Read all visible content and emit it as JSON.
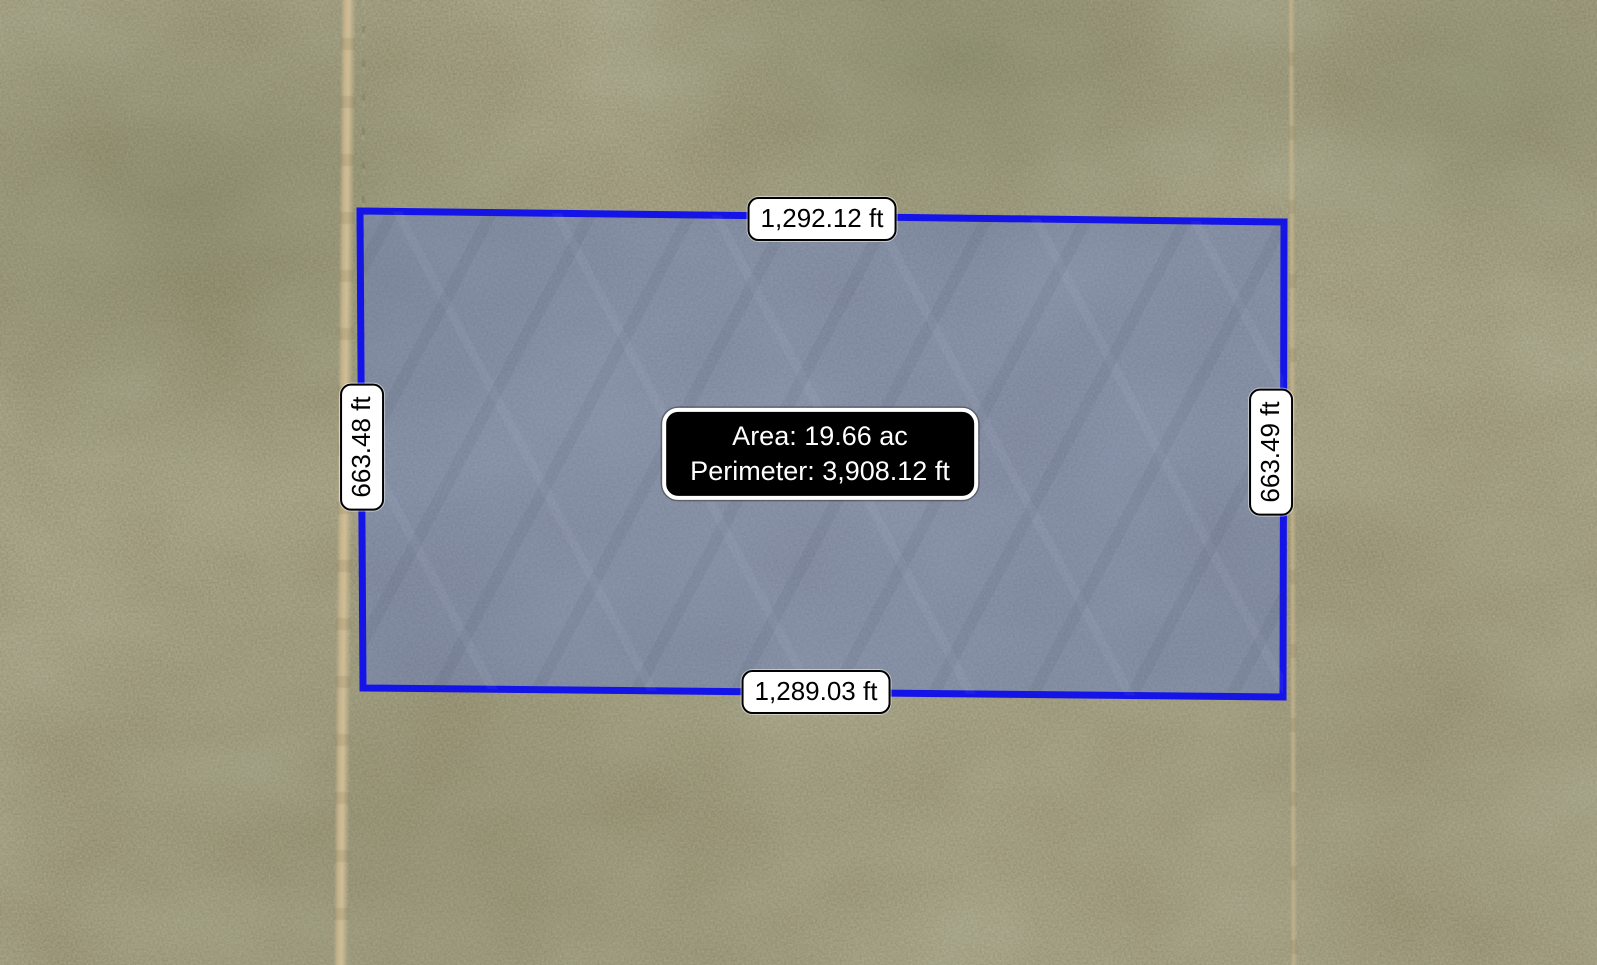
{
  "map": {
    "view": "satellite-parcel-measurement",
    "edge_labels": {
      "top": "1,292.12 ft",
      "bottom": "1,289.03 ft",
      "left": "663.48 ft",
      "right": "663.49 ft"
    },
    "tooltip": {
      "area": "Area: 19.66 ac",
      "perimeter": "Perimeter: 3,908.12 ft"
    },
    "parcel": {
      "points": "360,211 1284,222 1283,697 363,688",
      "stroke_color": "#1414e8",
      "fill_color": "rgba(88,118,212,0.40)",
      "stroke_width": "7"
    },
    "colors": {
      "terrain_base": "#8f8a6c",
      "road": "#c9b78e",
      "label_bg": "#ffffff",
      "label_border": "#000000",
      "label_text": "#000000",
      "tooltip_bg": "#000000",
      "tooltip_border": "#ffffff",
      "tooltip_text": "#ffffff"
    }
  }
}
